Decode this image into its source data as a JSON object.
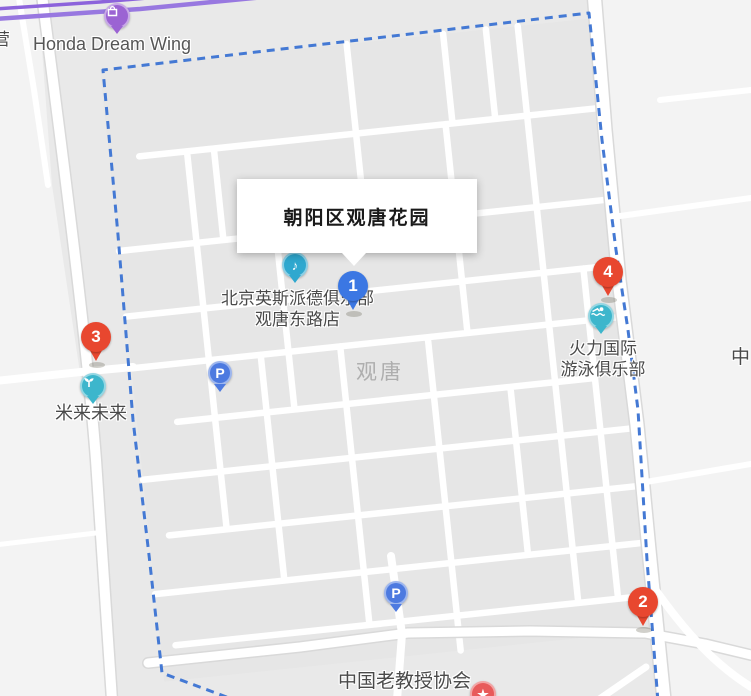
{
  "window": {
    "app": "map-view",
    "selected_place": "朝阳区观唐花园"
  },
  "info_window": {
    "title": "朝阳区观唐花园"
  },
  "area_label": "观唐",
  "edge_labels": {
    "left_partial": "营",
    "right_partial": "中"
  },
  "markers": [
    {
      "number": "1",
      "color": "#3b77e3",
      "kind": "result-pin"
    },
    {
      "number": "2",
      "color": "#e8472f",
      "kind": "result-pin"
    },
    {
      "number": "3",
      "color": "#e8472f",
      "kind": "result-pin"
    },
    {
      "number": "4",
      "color": "#e8472f",
      "kind": "result-pin"
    }
  ],
  "pois": [
    {
      "name": "Honda Dream Wing",
      "icon": "shopping-bag-icon",
      "color": "#9b63d3"
    },
    {
      "name_line1": "北京英斯派德俱乐部",
      "name_line2": "观唐东路店",
      "icon": "music-note-icon",
      "color": "#2fa8cf"
    },
    {
      "name": "米来未来",
      "icon": "sprout-icon",
      "color": "#3db6cc"
    },
    {
      "name_line1": "火力国际",
      "name_line2": "游泳俱乐部",
      "icon": "swimmer-icon",
      "color": "#3db6cc"
    },
    {
      "name": "中国老教授协会",
      "icon": "star-icon",
      "color": "#e85a5a"
    }
  ],
  "parking": {
    "glyph": "P",
    "color": "#4d7ae0",
    "count": 2
  },
  "icons": {
    "star_glyph": "★",
    "music_glyph": "♪"
  },
  "map_colors": {
    "boundary_dash": "#4479d4",
    "highway_purple": "#9878e0",
    "road": "#ffffff",
    "block": "#e7e7e7",
    "outer_area": "#f3f3f3"
  }
}
